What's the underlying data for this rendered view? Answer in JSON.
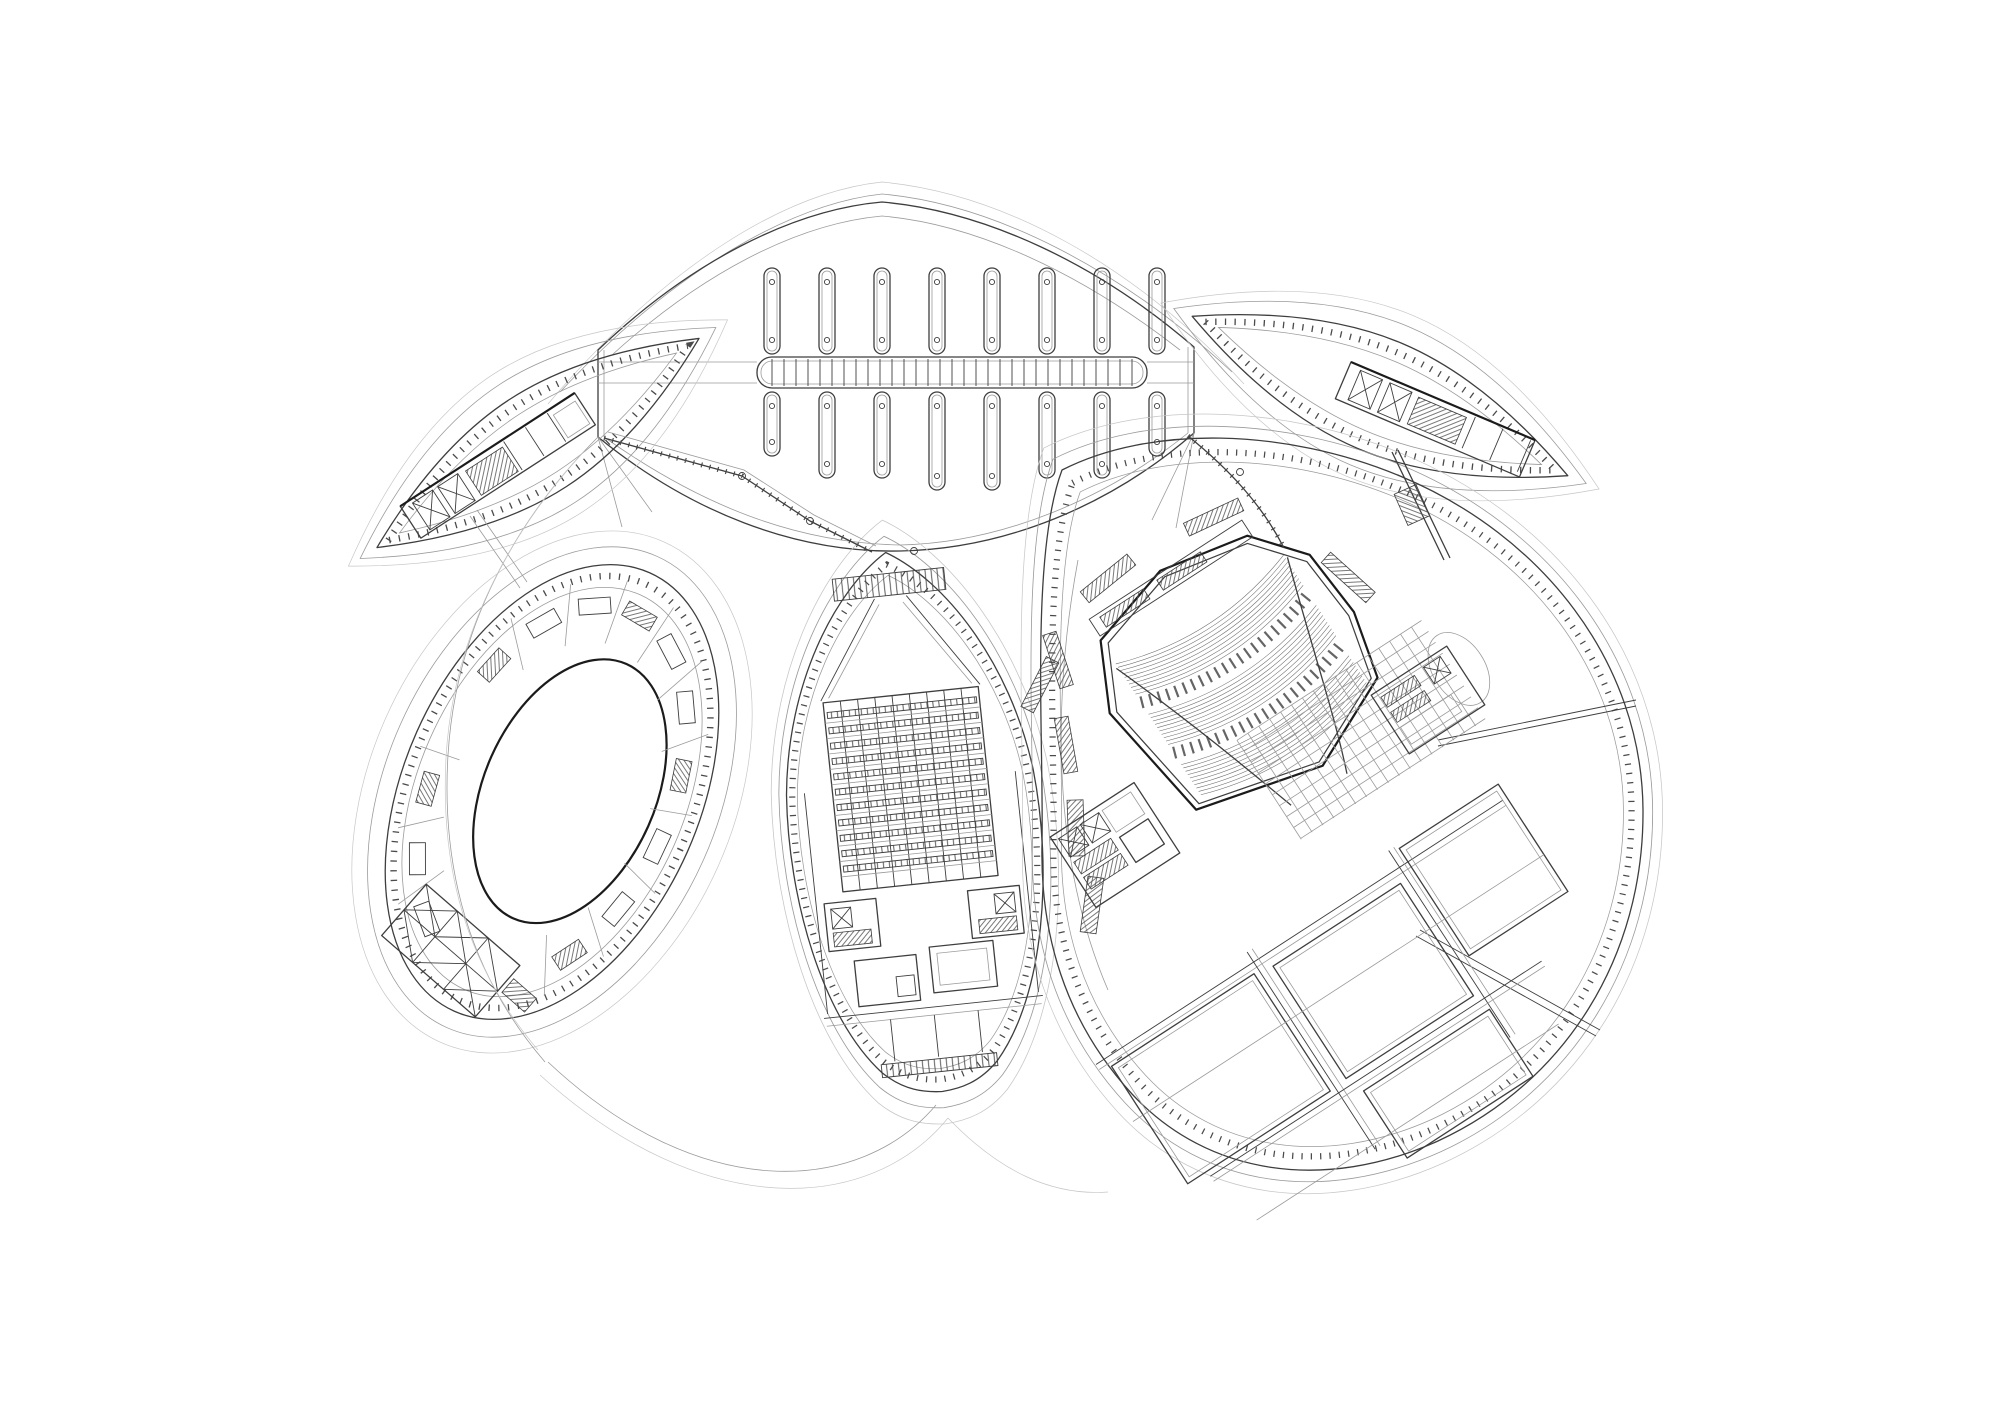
{
  "canvas": {
    "width": 2000,
    "height": 1414,
    "background": "#ffffff"
  },
  "colors": {
    "ink_heavy": "#1b1b1b",
    "ink_medium": "#3e3e3e",
    "ink_light": "#9b9b9b",
    "ink_faint": "#c7c7c7",
    "tick": "#4a4a4a",
    "hatch": "#565656",
    "seat": "#6b6b6b"
  },
  "fan": {
    "slots_top": 8,
    "slots_bottom": 8,
    "slot_width": 16,
    "pitch": 55,
    "x_first": 772,
    "row_top_y": 268,
    "row_top_len": 86,
    "row_bottom_y": 392,
    "row_bottom_lens": [
      64,
      86,
      86,
      98,
      98,
      86,
      86,
      64
    ],
    "end_circle_r": 2.6,
    "end_circle_inset": 14,
    "ladder": {
      "x1": 757,
      "x2": 1147,
      "y1": 357,
      "y2": 388,
      "rung_pitch": 12,
      "corner_r": 15
    }
  },
  "leaf_left": {
    "cx": 538,
    "cy": 443,
    "angle": -33,
    "half_len": 192,
    "half_w": 52
  },
  "leaf_right": {
    "cx": 1380,
    "cy": 396,
    "angle": 23,
    "half_len": 204,
    "half_w": 57
  },
  "left_oval": {
    "cx": 552,
    "cy": 792,
    "angle": 24,
    "rx": 148,
    "ry": 240,
    "court_scale": 0.58,
    "court_dx": 16,
    "court_dy": -8,
    "room_angles": [
      -152,
      -130,
      -108,
      -86,
      -64,
      -42,
      -20,
      2,
      24,
      46,
      122,
      144,
      166
    ],
    "room_hatch_every": 3
  },
  "teardrop": {
    "cx": 914,
    "cy": 822,
    "angle": -6,
    "grid": {
      "x": -78,
      "y": -128,
      "w": 156,
      "h": 190,
      "cols": 9,
      "bands": 11
    }
  },
  "egg": {
    "cx": 1342,
    "cy": 808
  },
  "auditorium": {
    "cx": 1252,
    "cy": 690,
    "angle": -33,
    "banks": 3,
    "rows_per_bank": 10,
    "row_pitch": 4.0,
    "row_x1": -100,
    "row_x2": 100,
    "bulge": 34,
    "bank_starts_y": [
      -96,
      -36,
      24
    ],
    "aisle_offsets": [
      -50,
      10
    ]
  },
  "floor_grid": {
    "x1": -40,
    "x2": 180,
    "y1": 34,
    "y2": 152,
    "step": 13
  },
  "walkway_nodes": [
    [
      742,
      476
    ],
    [
      810,
      521
    ],
    [
      1240,
      472
    ],
    [
      914,
      551
    ]
  ]
}
